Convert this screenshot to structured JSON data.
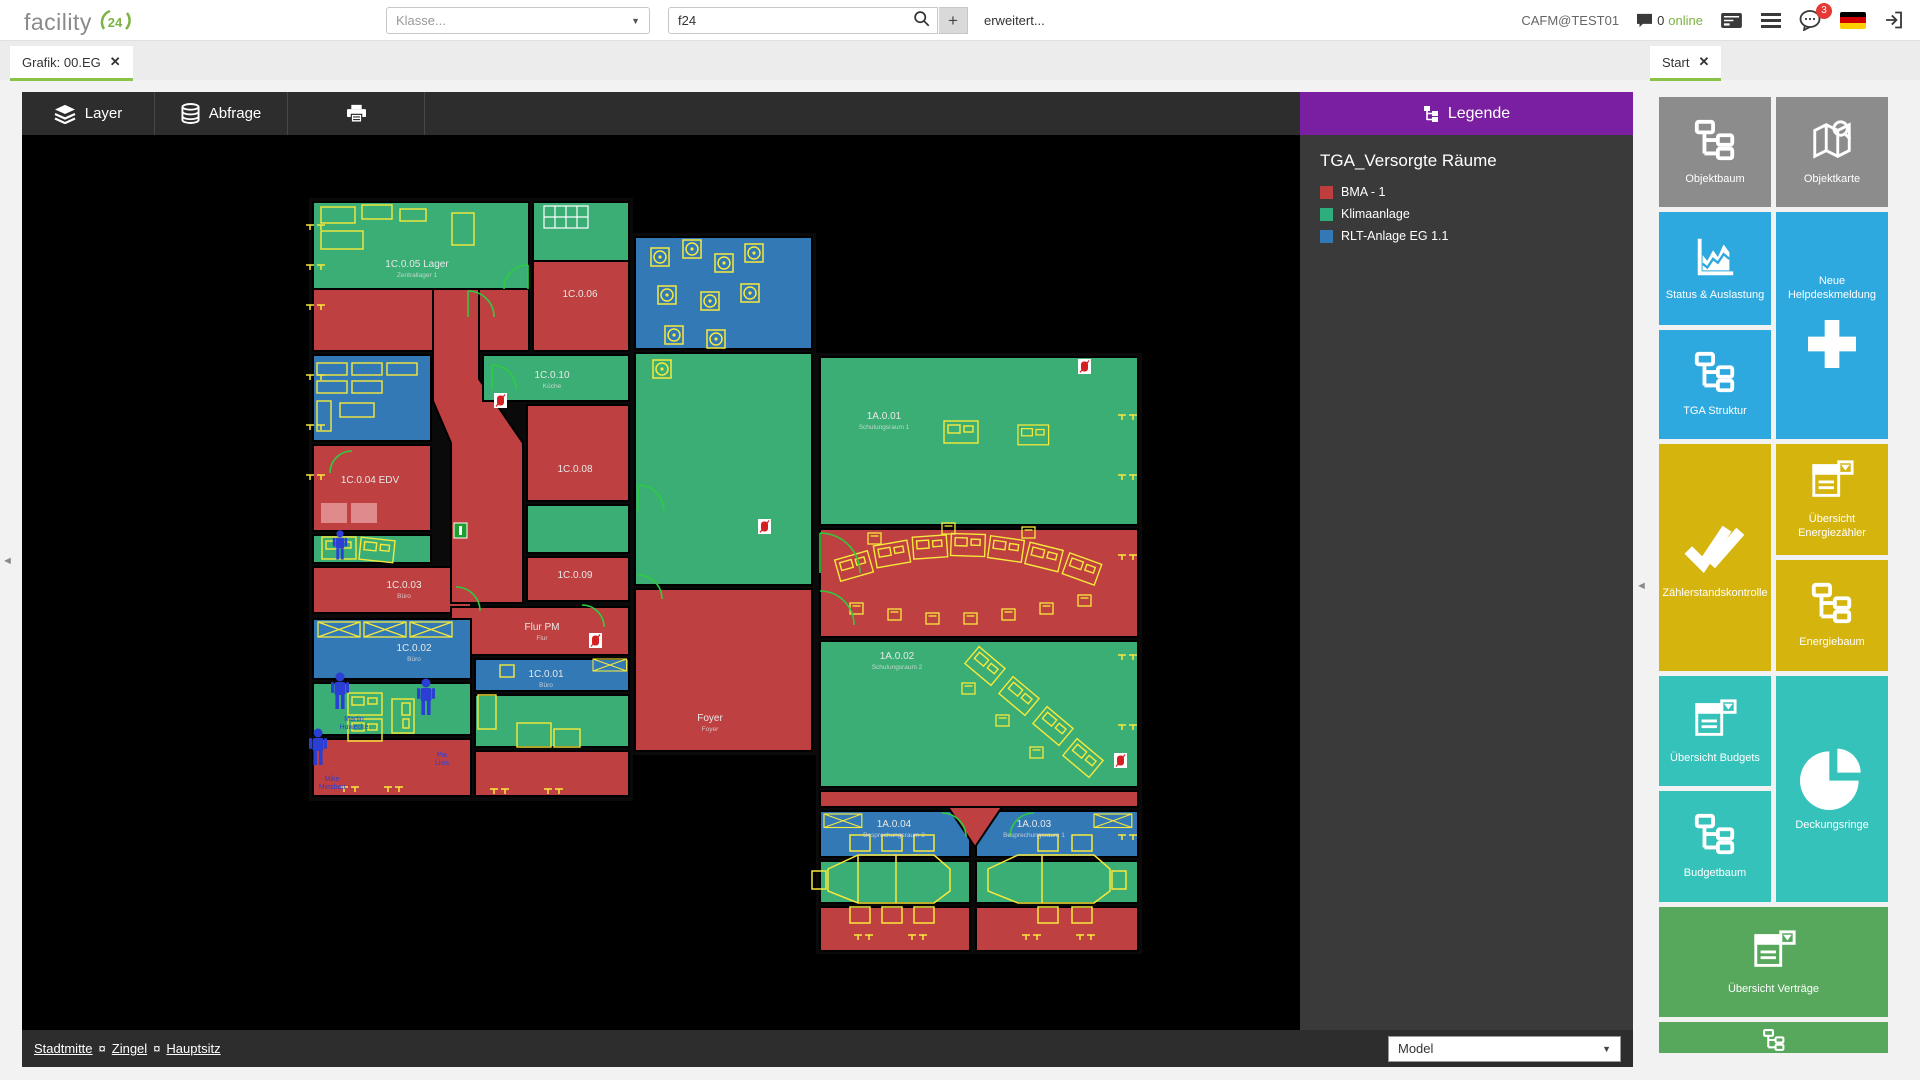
{
  "header": {
    "logo_text": "facility",
    "logo_badge": "24",
    "klasse_placeholder": "Klasse...",
    "search_value": "f24",
    "plus_label": "+",
    "erweitert_label": "erweitert...",
    "user": "CAFM@TEST01",
    "online_count": "0",
    "online_label": "online",
    "badge_count": "3"
  },
  "tabs": {
    "grafik": "Grafik: 00.EG",
    "start": "Start",
    "close": "✕"
  },
  "toolbar": {
    "layer": "Layer",
    "abfrage": "Abfrage"
  },
  "legend": {
    "title": "Legende",
    "subtitle": "TGA_Versorgte Räume",
    "items": [
      {
        "label": "BMA - 1",
        "color": "#be3e3e"
      },
      {
        "label": "Klimaanlage",
        "color": "#2eae7d"
      },
      {
        "label": "RLT-Anlage EG 1.1",
        "color": "#3279b5"
      }
    ]
  },
  "sidebar": {
    "tiles": [
      {
        "label": "Objektbaum",
        "color": "#8c8c8c",
        "icon": "tree-icon"
      },
      {
        "label": "Objektkarte",
        "color": "#8c8c8c",
        "icon": "map-icon"
      },
      {
        "label": "Status & Auslastung",
        "color": "#2ea9df",
        "icon": "chart-icon"
      },
      {
        "label": "Neue Helpdeskmeldung",
        "color": "#2ea9df",
        "icon": "plus-icon"
      },
      {
        "label": "TGA Struktur",
        "color": "#2ea9df",
        "icon": "tree-icon"
      },
      {
        "label": "Zählerstandskontrolle",
        "color": "#d5b40e",
        "icon": "check-icon"
      },
      {
        "label": "Übersicht Energiezähler",
        "color": "#d5b40e",
        "icon": "report-icon"
      },
      {
        "label": "Energiebaum",
        "color": "#d5b40e",
        "icon": "tree-icon"
      },
      {
        "label": "Übersicht Budgets",
        "color": "#35c2ba",
        "icon": "report-icon"
      },
      {
        "label": "Deckungsringe",
        "color": "#35c2ba",
        "icon": "pie-icon"
      },
      {
        "label": "Budgetbaum",
        "color": "#35c2ba",
        "icon": "tree-icon"
      },
      {
        "label": "Übersicht Verträge",
        "color": "#57a85c",
        "icon": "report-icon"
      },
      {
        "label": "",
        "color": "#57a85c",
        "icon": "tree-icon"
      }
    ]
  },
  "statusbar": {
    "breadcrumbs": [
      "Stadtmitte",
      "Zingel",
      "Hauptsitz"
    ],
    "separator": "¤",
    "model_value": "Model"
  },
  "floorplan": {
    "rooms": [
      {
        "label": "1C.0.05 Lager",
        "sub": "Zentrallager 1"
      },
      {
        "label": "1C.0.06",
        "sub": ""
      },
      {
        "label": "1C.0.10",
        "sub": "Küche"
      },
      {
        "label": "1C.0.04 EDV",
        "sub": ""
      },
      {
        "label": "1C.0.08",
        "sub": ""
      },
      {
        "label": "1C.0.03",
        "sub": "Büro"
      },
      {
        "label": "1C.0.09",
        "sub": ""
      },
      {
        "label": "Flur PM",
        "sub": "Flur"
      },
      {
        "label": "1C.0.02",
        "sub": "Büro"
      },
      {
        "label": "1C.0.01",
        "sub": "Büro"
      },
      {
        "label": "Foyer",
        "sub": "Foyer"
      },
      {
        "label": "1A.0.01",
        "sub": "Schulungsraum 1"
      },
      {
        "label": "1A.0.02",
        "sub": "Schulungsraum 2"
      },
      {
        "label": "1A.0.04",
        "sub": "Besprechungsraum 2"
      },
      {
        "label": "1A.0.03",
        "sub": "Besprechungsraum 1"
      }
    ],
    "persons": [
      {
        "first": "Martin",
        "last": "Huwecke"
      },
      {
        "first": "Mike",
        "last": "Miesbau"
      },
      {
        "first": "Pia",
        "last": "Lixis"
      }
    ]
  }
}
